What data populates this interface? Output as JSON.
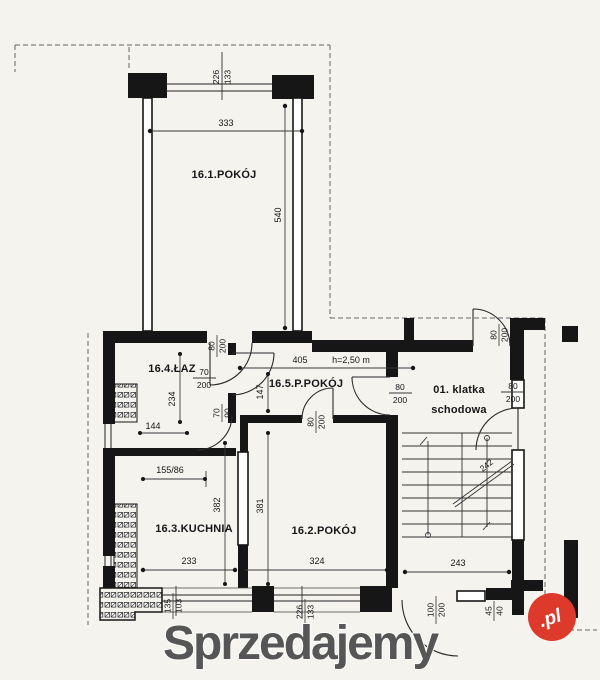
{
  "document": {
    "type": "apartment floor plan scan"
  },
  "colors": {
    "background": "#f4f3ee",
    "ink": "#161616",
    "dimline": "#3a3a3a",
    "watermark_text": "#565656",
    "watermark_badge": "#dd3a2c",
    "watermark_badge_text": "#ffffff"
  },
  "rooms": {
    "r16_1": {
      "label": "16.1.POKÓJ"
    },
    "r16_4": {
      "label": "16.4.ŁAZ"
    },
    "r16_5": {
      "label": "16.5.P.POKÓJ"
    },
    "r01": {
      "line1": "01. klatka",
      "line2": "schodowa"
    },
    "r16_3": {
      "label": "16.3.KUCHNIA"
    },
    "r16_2": {
      "label": "16.2.POKÓJ"
    }
  },
  "dimensions": {
    "top_width": "333",
    "room1_height": "540",
    "hall_width": "405",
    "ceiling_height": "h=2,50 m",
    "hall_depth": "147",
    "bath_depth": "234",
    "bath_width": "144",
    "kitchen_opening": "155/86",
    "kitchen_depth": "382",
    "room2_depth": "381",
    "kitchen_width": "233",
    "room2_width": "324",
    "stair_width": "243",
    "stair_flight": "242"
  },
  "openings": {
    "top_window": {
      "num": "226",
      "den": "133"
    },
    "hall_top_door": {
      "num": "80",
      "den": "200"
    },
    "bath_door": {
      "num": "70",
      "den": "200"
    },
    "bath_hatch": {
      "num": "70",
      "den": "90"
    },
    "room2_door": {
      "num": "80",
      "den": "200"
    },
    "stair_door": {
      "num": "80",
      "den": "200"
    },
    "right_door": {
      "num": "80",
      "den": "200"
    },
    "top_right_door": {
      "num": "80",
      "den": "200"
    },
    "bottom_left_window": {
      "num": "135",
      "den": "103"
    },
    "bottom_mid_window": {
      "num": "226",
      "den": "133"
    },
    "entrance_door": {
      "num": "100",
      "den": "200"
    },
    "vent": {
      "num": "45",
      "den": "40"
    }
  },
  "watermark": {
    "text": "Sprzedajemy",
    "badge": ".pl"
  }
}
